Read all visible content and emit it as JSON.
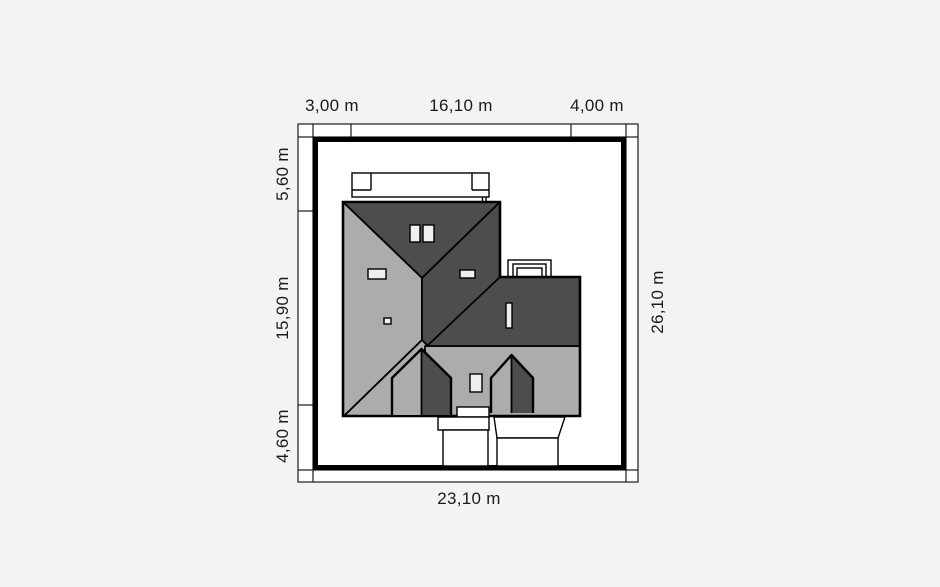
{
  "plan": {
    "type": "house-site-plan-roof-view",
    "dimensions": {
      "top": [
        "3,00 m",
        "16,10 m",
        "4,00 m"
      ],
      "left": [
        "5,60 m",
        "15,90 m",
        "4,60 m"
      ],
      "right": [
        "26,10 m"
      ],
      "bottom": [
        "23,10 m"
      ]
    },
    "colors": {
      "page_background": "#f3f3f1",
      "plot_fill": "#ffffff",
      "roof_dark": "#4d4d4d",
      "roof_light": "#acacac",
      "line": "#000000",
      "label_text": "#1b1b1b"
    }
  }
}
